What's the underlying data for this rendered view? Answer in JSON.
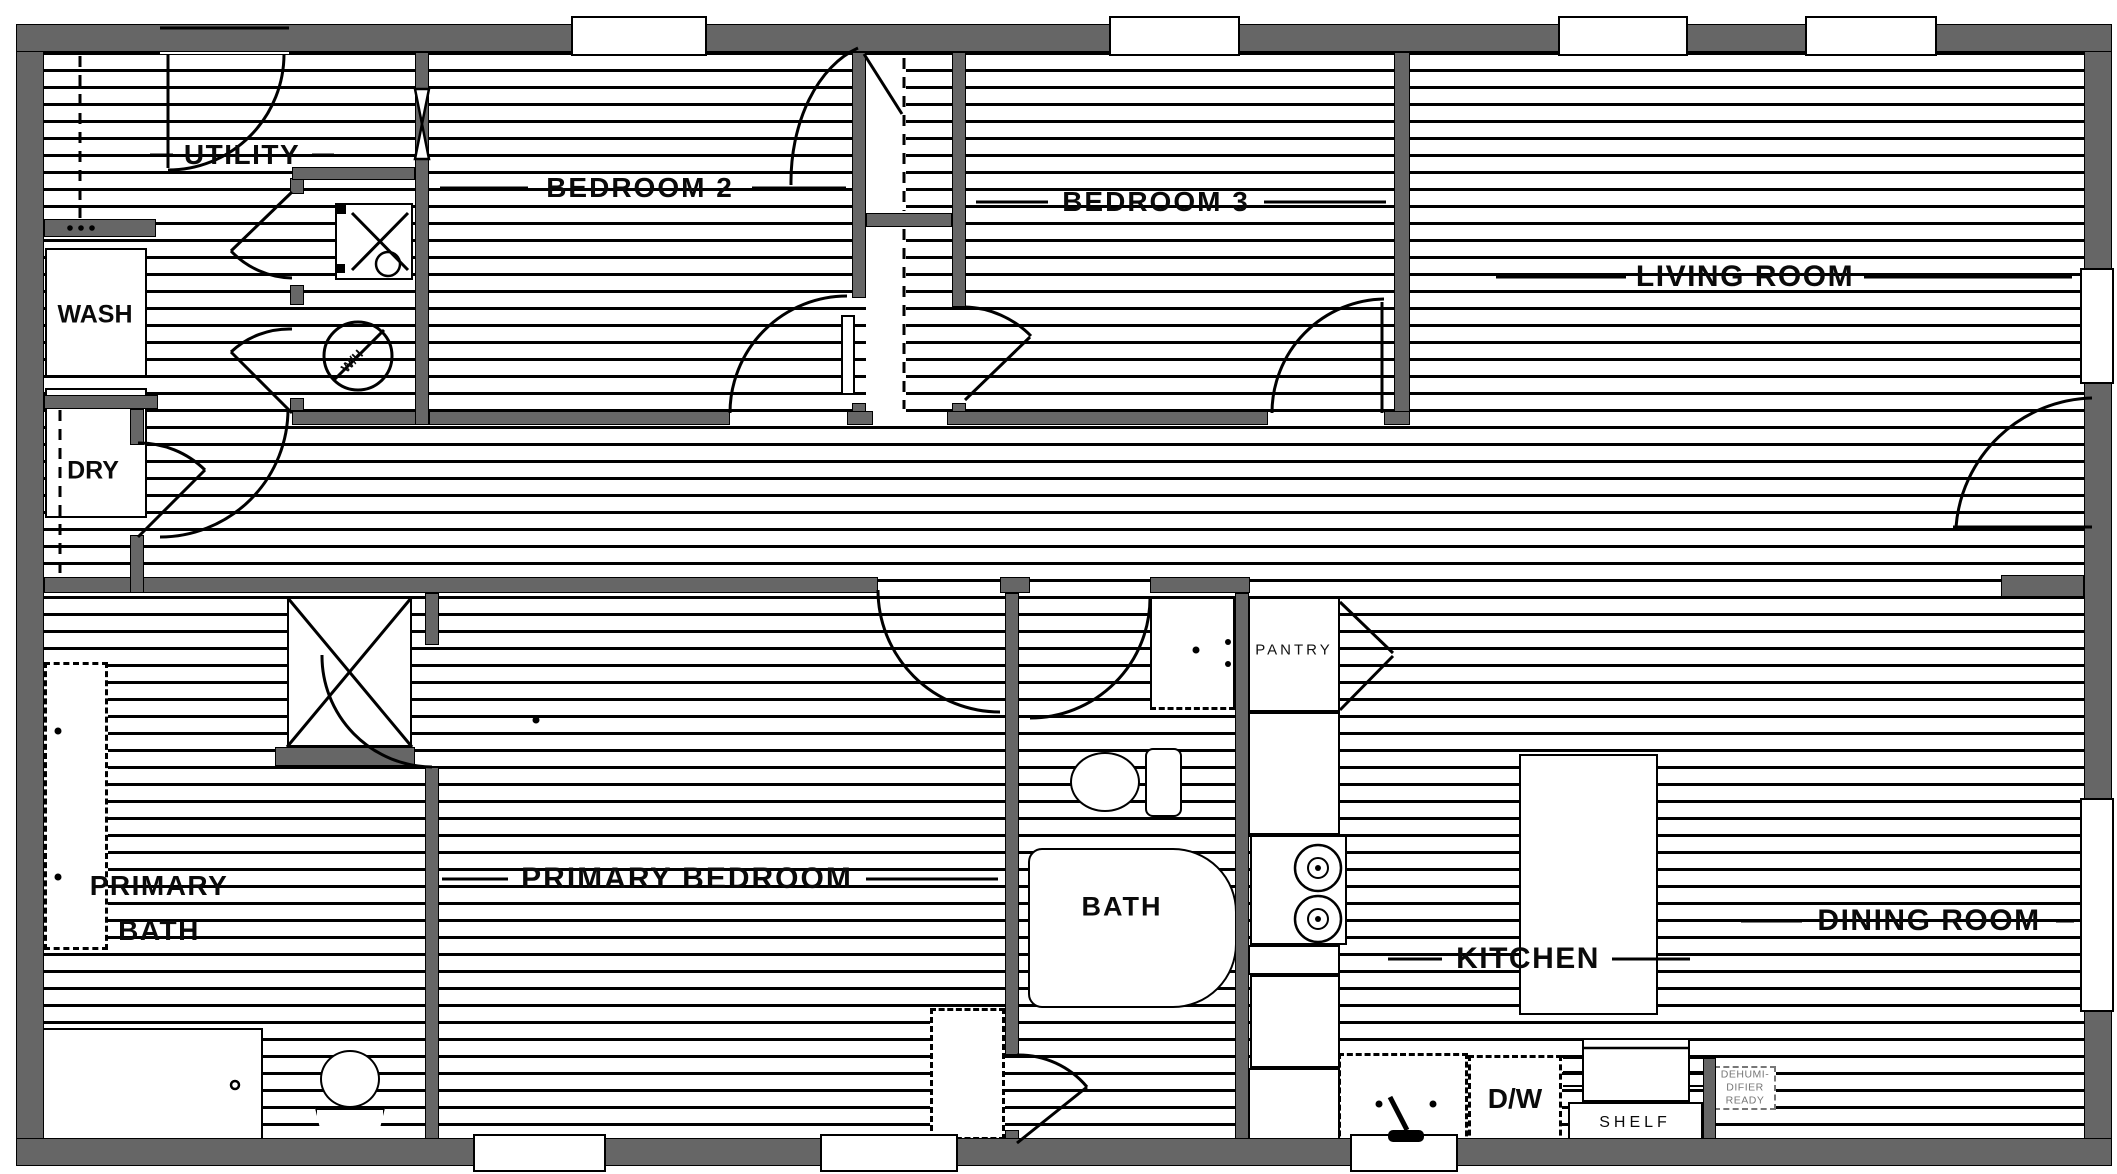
{
  "meta": {
    "type": "floor-plan",
    "colors": {
      "wall": "#666666",
      "line": "#000000",
      "background": "#ffffff",
      "muted_text": "#777777"
    }
  },
  "rooms": {
    "utility": "UTILITY",
    "bedroom2": "BEDROOM 2",
    "bedroom3": "BEDROOM 3",
    "living": "LIVING ROOM",
    "primary_bath_line1": "PRIMARY",
    "primary_bath_line2": "BATH",
    "primary_bedroom": "PRIMARY BEDROOM",
    "bath": "BATH",
    "pantry": "PANTRY",
    "kitchen": "KITCHEN",
    "dining": "DINING ROOM"
  },
  "fixtures": {
    "washer": "WASH",
    "dryer": "DRY",
    "water_heater": "W/H",
    "dishwasher": "D/W",
    "shelf": "SHELF",
    "dehumidifier": [
      "DEHUMI-",
      "DIFIER",
      "READY"
    ]
  }
}
